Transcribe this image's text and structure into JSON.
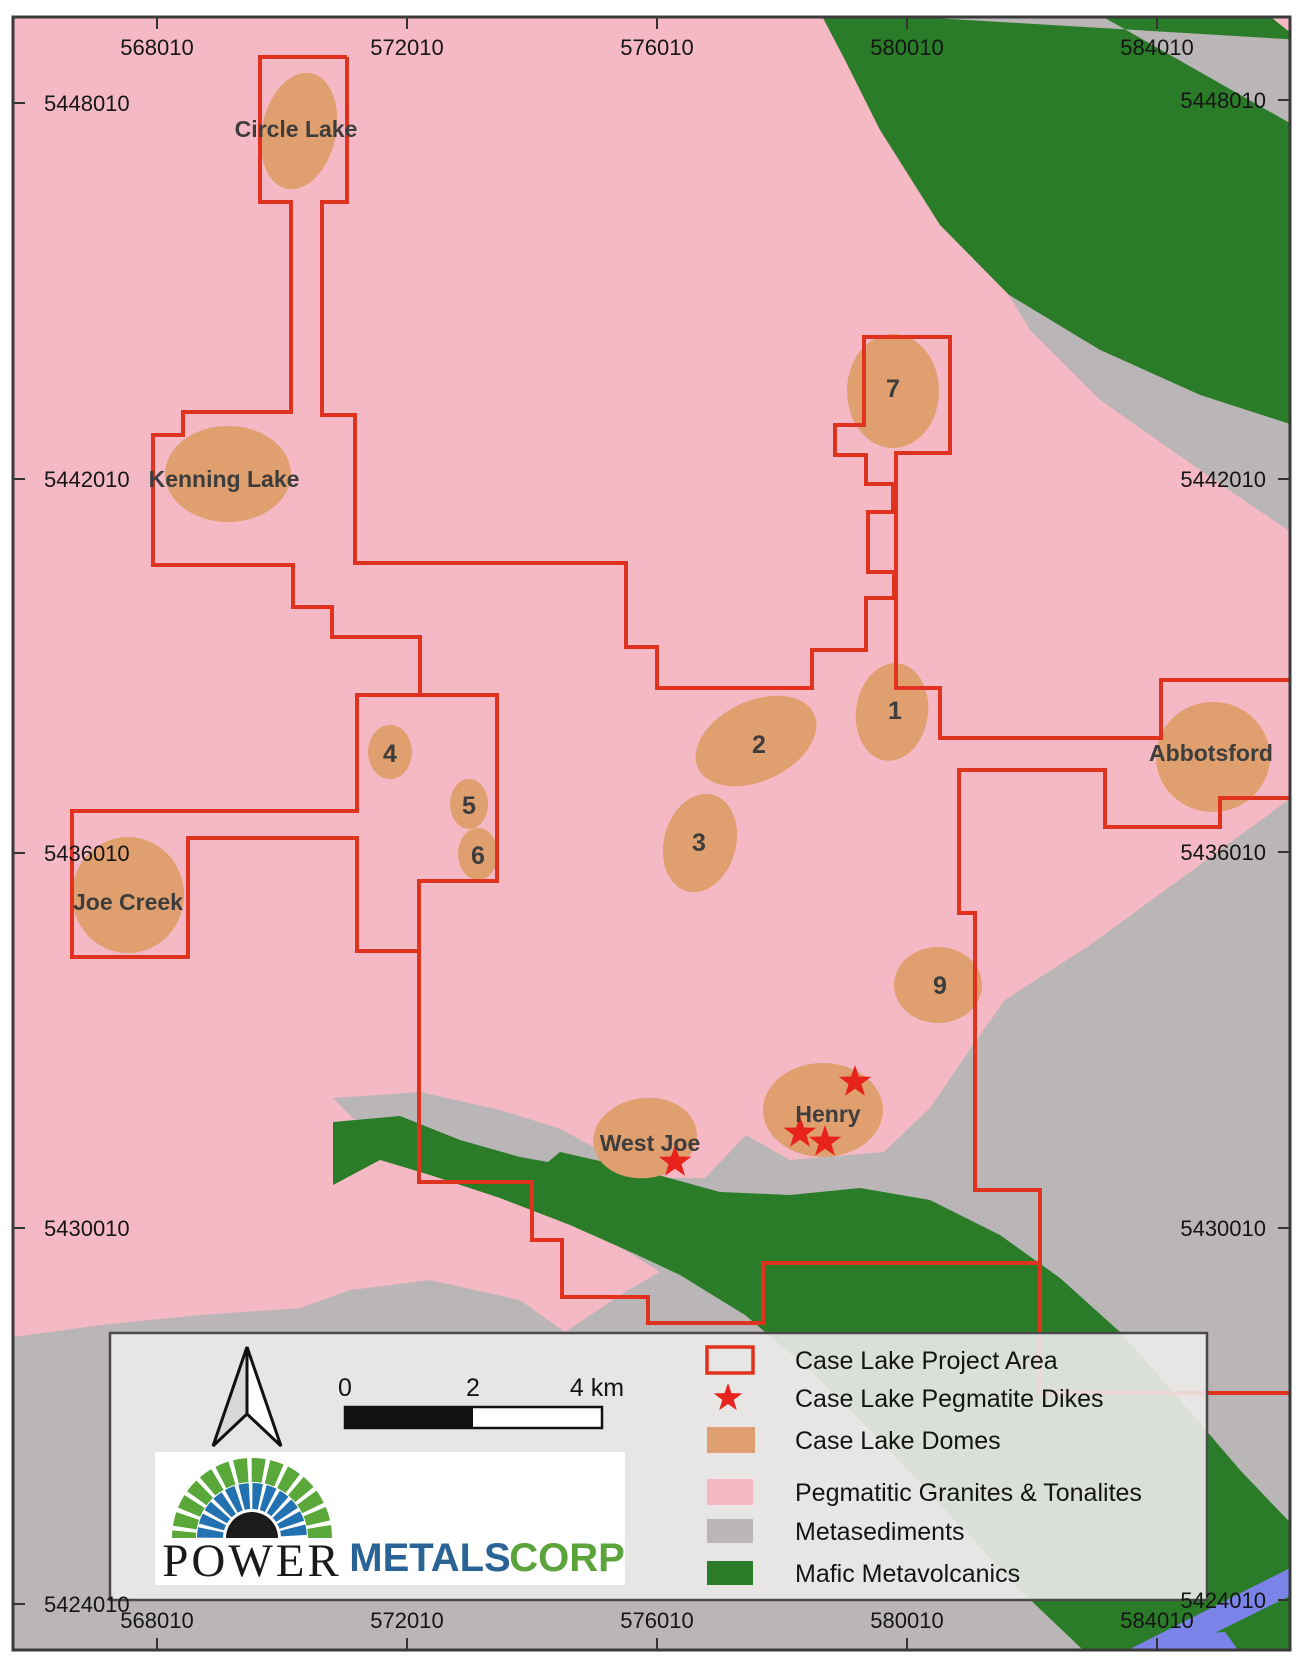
{
  "colors": {
    "pink": "#f4b9c5",
    "tan": "#df9f6e",
    "green": "#2a7c28",
    "gray": "#bab5b6",
    "blue": "#7b83e8",
    "red": "#e0331f",
    "star_red": "#e8221c",
    "legend_bg": "rgba(237,235,234,0.90)",
    "frame": "#3a3a3a",
    "label": "#3d3d3d",
    "logo_blue": "#2a6496",
    "logo_green": "#5ba33b"
  },
  "axis": {
    "top": [
      {
        "label": "568010",
        "x": 157
      },
      {
        "label": "572010",
        "x": 407
      },
      {
        "label": "576010",
        "x": 657
      },
      {
        "label": "580010",
        "x": 907
      },
      {
        "label": "584010",
        "x": 1157
      }
    ],
    "bottom": [
      {
        "label": "568010",
        "x": 157
      },
      {
        "label": "572010",
        "x": 407
      },
      {
        "label": "576010",
        "x": 657
      },
      {
        "label": "580010",
        "x": 907
      },
      {
        "label": "584010",
        "x": 1157
      }
    ],
    "left": [
      {
        "label": "5448010",
        "y": 103
      },
      {
        "label": "5442010",
        "y": 479
      },
      {
        "label": "5436010",
        "y": 853
      },
      {
        "label": "5430010",
        "y": 1228
      },
      {
        "label": "5424010",
        "y": 1604
      }
    ],
    "right": [
      {
        "label": "5448010",
        "y": 100
      },
      {
        "label": "5442010",
        "y": 479
      },
      {
        "label": "5436010",
        "y": 852
      },
      {
        "label": "5430010",
        "y": 1228
      },
      {
        "label": "5424010",
        "y": 1600
      }
    ]
  },
  "domes": [
    {
      "id": "circle-lake",
      "label": "Circle Lake",
      "kind": "name",
      "cx": 299,
      "cy": 131,
      "rx": 37,
      "ry": 59,
      "rot": 12,
      "lx": 296,
      "ly": 129
    },
    {
      "id": "kenning-lake",
      "label": "Kenning Lake",
      "kind": "name",
      "cx": 228,
      "cy": 474,
      "rx": 63,
      "ry": 48,
      "rot": 0,
      "lx": 224,
      "ly": 479
    },
    {
      "id": "joe-creek",
      "label": "Joe Creek",
      "kind": "name",
      "cx": 128,
      "cy": 895,
      "rx": 56,
      "ry": 58,
      "rot": 0,
      "lx": 128,
      "ly": 902
    },
    {
      "id": "abbotsford",
      "label": "Abbotsford",
      "kind": "name",
      "cx": 1213,
      "cy": 757,
      "rx": 57,
      "ry": 55,
      "rot": 0,
      "lx": 1211,
      "ly": 753
    },
    {
      "id": "west-joe",
      "label": "West Joe",
      "kind": "name",
      "cx": 645,
      "cy": 1138,
      "rx": 52,
      "ry": 40,
      "rot": -8,
      "lx": 650,
      "ly": 1143
    },
    {
      "id": "henry",
      "label": "Henry",
      "kind": "name",
      "cx": 823,
      "cy": 1110,
      "rx": 60,
      "ry": 47,
      "rot": 0,
      "lx": 828,
      "ly": 1114
    },
    {
      "id": "dome-1",
      "label": "1",
      "kind": "number",
      "cx": 892,
      "cy": 712,
      "rx": 36,
      "ry": 49,
      "rot": 8,
      "lx": 895,
      "ly": 711
    },
    {
      "id": "dome-2",
      "label": "2",
      "kind": "number",
      "cx": 756,
      "cy": 741,
      "rx": 64,
      "ry": 40,
      "rot": -25,
      "lx": 759,
      "ly": 745
    },
    {
      "id": "dome-3",
      "label": "3",
      "kind": "number",
      "cx": 700,
      "cy": 843,
      "rx": 36,
      "ry": 50,
      "rot": 15,
      "lx": 699,
      "ly": 843
    },
    {
      "id": "dome-4",
      "label": "4",
      "kind": "number",
      "cx": 390,
      "cy": 752,
      "rx": 22,
      "ry": 27,
      "rot": 0,
      "lx": 390,
      "ly": 754
    },
    {
      "id": "dome-5",
      "label": "5",
      "kind": "number",
      "cx": 469,
      "cy": 804,
      "rx": 19,
      "ry": 25,
      "rot": 0,
      "lx": 469,
      "ly": 806
    },
    {
      "id": "dome-6",
      "label": "6",
      "kind": "number",
      "cx": 478,
      "cy": 854,
      "rx": 20,
      "ry": 26,
      "rot": 0,
      "lx": 478,
      "ly": 856
    },
    {
      "id": "dome-7",
      "label": "7",
      "kind": "number",
      "cx": 893,
      "cy": 391,
      "rx": 46,
      "ry": 57,
      "rot": 0,
      "lx": 893,
      "ly": 389
    },
    {
      "id": "dome-9",
      "label": "9",
      "kind": "number",
      "cx": 938,
      "cy": 985,
      "rx": 44,
      "ry": 38,
      "rot": 0,
      "lx": 940,
      "ly": 986
    }
  ],
  "stars": [
    {
      "id": "west-joe-dike",
      "x": 675,
      "y": 1162
    },
    {
      "id": "henry-dike-north",
      "x": 855,
      "y": 1082
    },
    {
      "id": "henry-dike-west",
      "x": 800,
      "y": 1133
    },
    {
      "id": "henry-dike-east",
      "x": 825,
      "y": 1142
    }
  ],
  "legend": {
    "items": [
      {
        "label": "Case Lake Project Area",
        "swatch": "outline"
      },
      {
        "label": "Case Lake Pegmatite Dikes",
        "swatch": "star"
      },
      {
        "label": "Case Lake Domes",
        "swatch": "tan"
      },
      {
        "label": "Pegmatitic Granites & Tonalites",
        "swatch": "pink"
      },
      {
        "label": "Metasediments",
        "swatch": "gray"
      },
      {
        "label": "Mafic Metavolcanics",
        "swatch": "green"
      }
    ]
  },
  "scalebar": {
    "t0": "0",
    "t2": "2",
    "t4": "4 km"
  },
  "logo": {
    "power": "POWER",
    "metals": "METALS",
    "corp": "CORP"
  }
}
